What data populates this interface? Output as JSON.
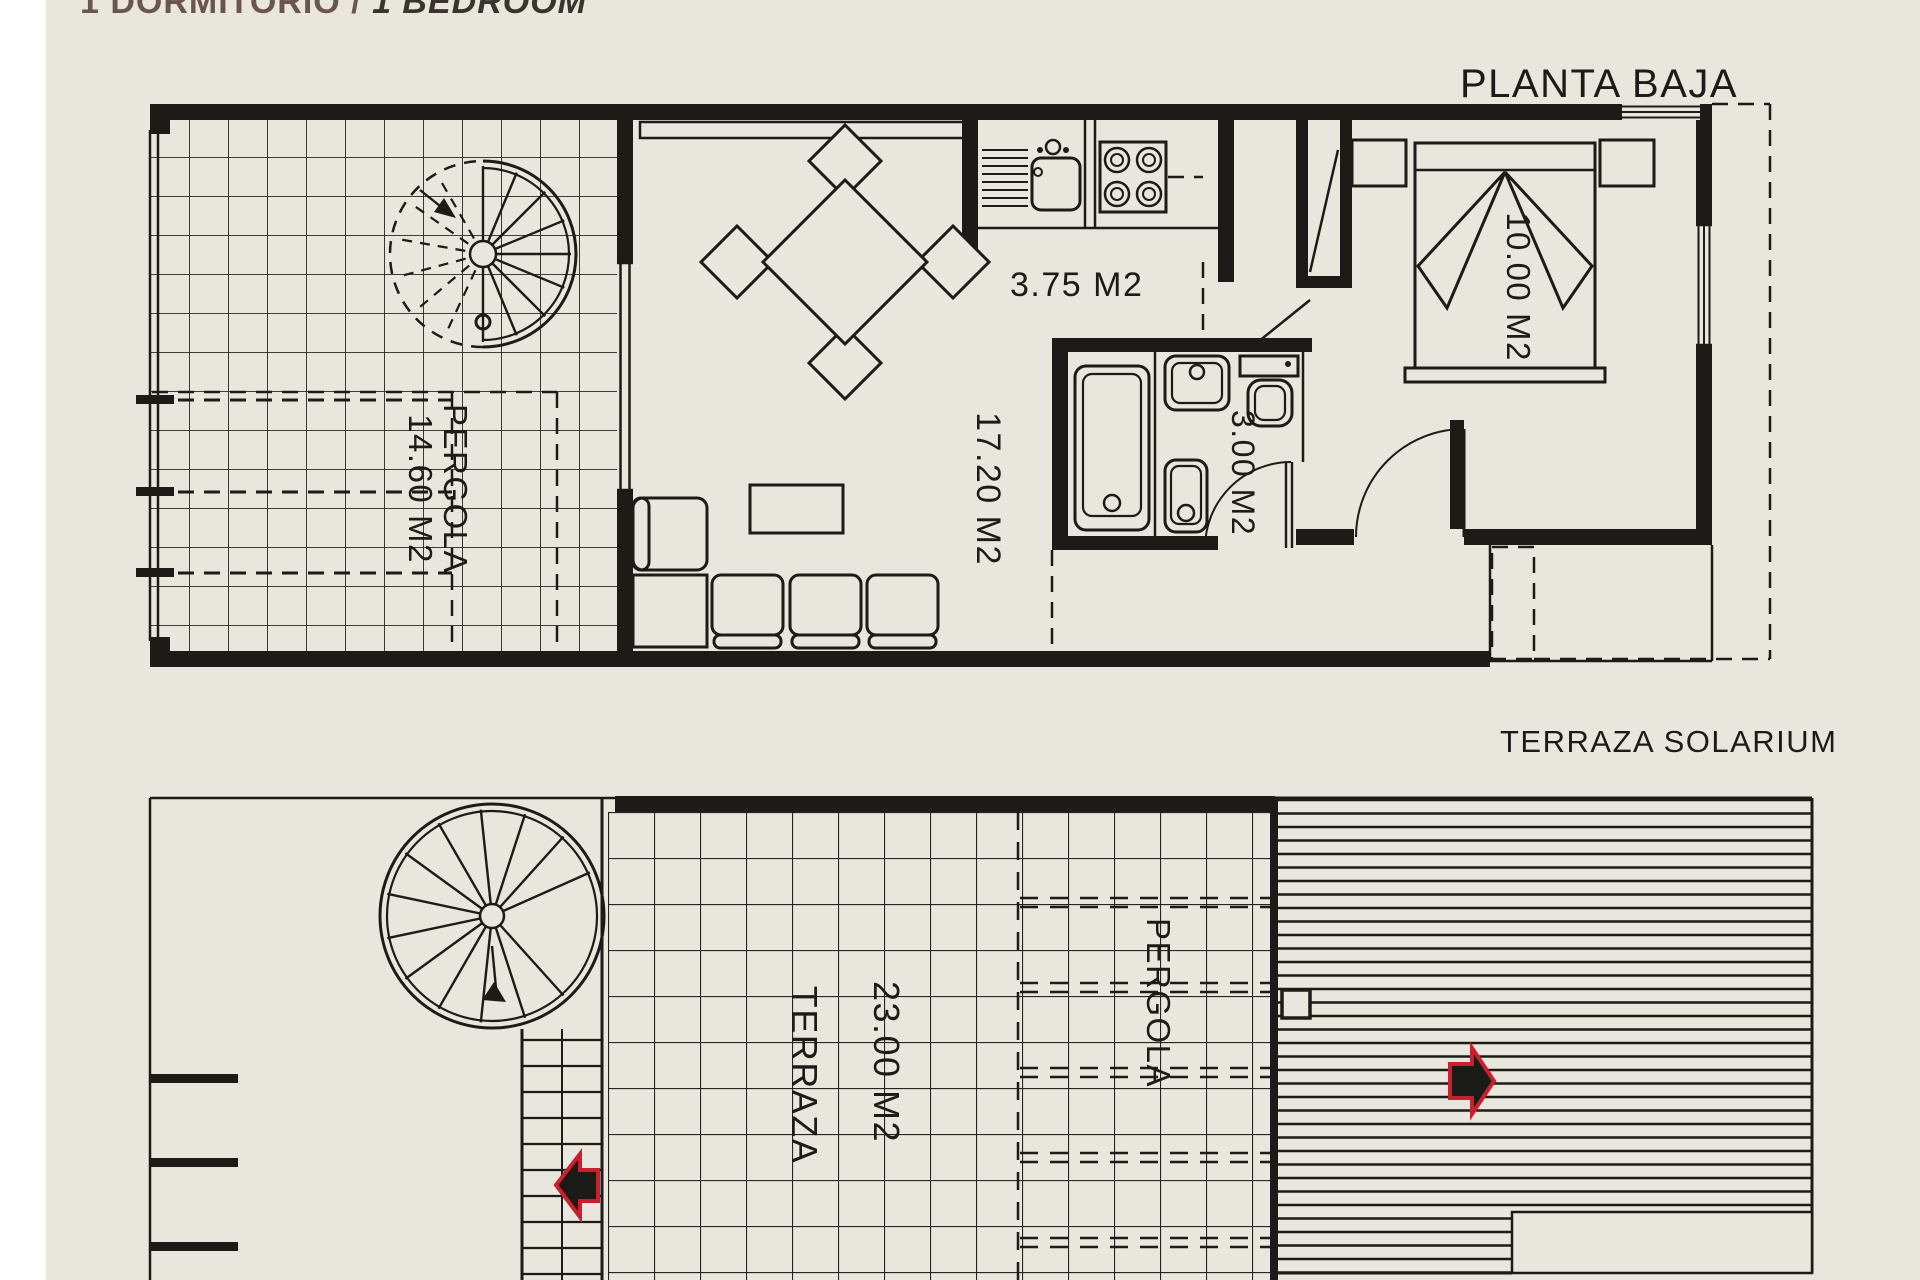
{
  "palette": {
    "background": "#e8e6dd",
    "ink": "#1c1b18",
    "title_brown": "#6a5650",
    "title_dark": "#3a342e",
    "arrow_red": "#c8202e"
  },
  "header": {
    "title_part1": "1 DORMITORIO /",
    "title_part2": "1 BEDROOM"
  },
  "floor_plans": {
    "ground_floor": {
      "title": "PLANTA BAJA",
      "labels": {
        "kitchen": "3.75 M2",
        "living": "17.20 M2",
        "bathroom": "3.00 M2",
        "bedroom": "10.00 M2",
        "pergola_name": "PERGOLA",
        "pergola_area": "14.60 M2"
      }
    },
    "roof_terrace": {
      "title": "TERRAZA SOLARIUM",
      "labels": {
        "terrace_name": "TERRAZA",
        "terrace_area": "23.00 M2",
        "pergola_name": "PERGOLA"
      }
    }
  }
}
